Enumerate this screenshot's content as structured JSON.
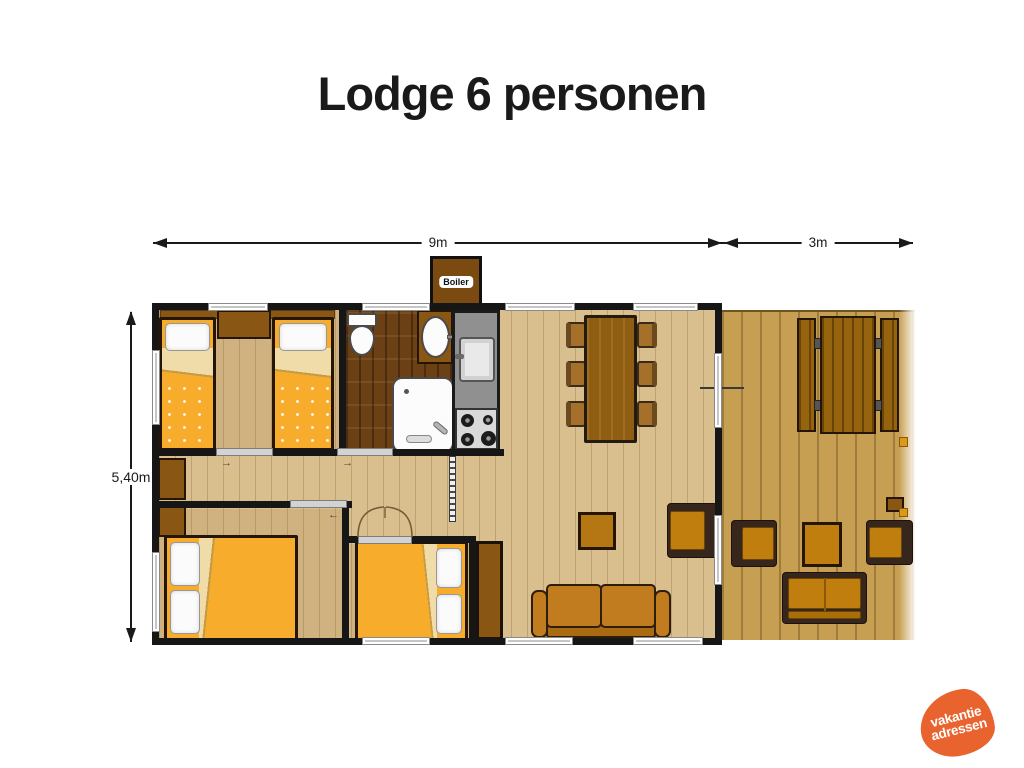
{
  "title": "Lodge 6 personen",
  "dimensions": {
    "main_width": "9m",
    "deck_width": "3m",
    "height": "5,40m"
  },
  "labels": {
    "boiler": "Boiler"
  },
  "logo": {
    "line1": "vakantie",
    "line2": "adressen",
    "color": "#E8632E"
  },
  "colors": {
    "wall": "#161616",
    "floor_wood": "#D9BE8E",
    "floor_bathroom": "#6B4015",
    "deck_wood": "#C79F52",
    "furniture_brown": "#8A5613",
    "bed_yellow": "#F7AD2B",
    "sheet_cream": "#EFDCA8",
    "cushion_orange": "#BF7E0E",
    "counter_gray": "#909090",
    "title_text": "#1A1A1A"
  }
}
